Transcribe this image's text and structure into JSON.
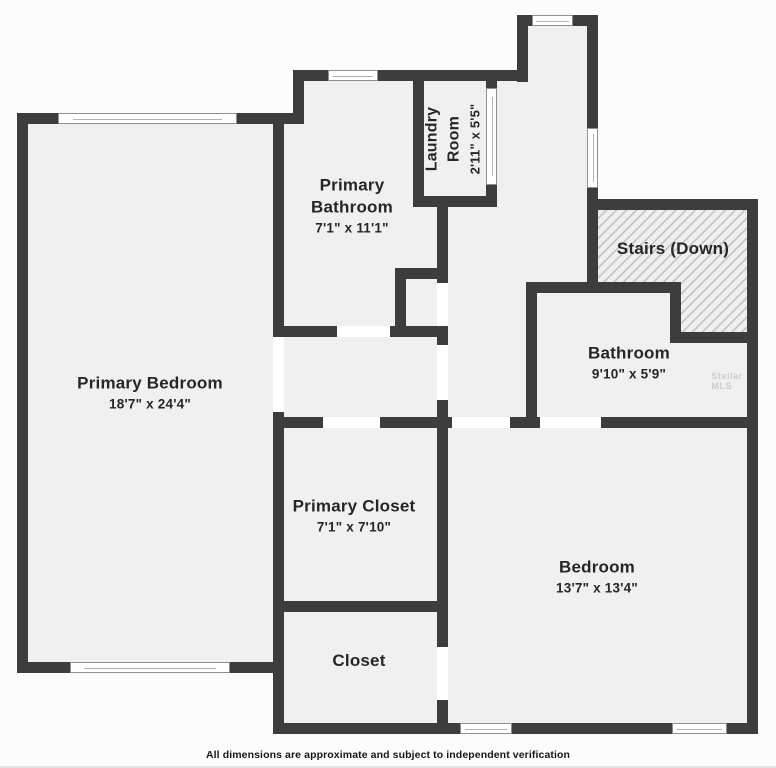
{
  "plan": {
    "disclaimer": "All dimensions are approximate and subject to independent verification",
    "watermark": "Stellar MLS",
    "colors": {
      "wall": "#3d3d3d",
      "room_fill": "#f0f0f0",
      "outside": "#fcfcfc",
      "window_fill": "#ffffff",
      "window_border": "#8f8f8f",
      "hatch_line": "#c6c6c6",
      "label_text": "#262626"
    },
    "rooms": [
      {
        "name": "Primary Bedroom",
        "dims": "18'7\" x 24'4\"",
        "cx": 150,
        "cy": 393,
        "rotate": 0,
        "wrap": 0
      },
      {
        "name": "Primary Bathroom",
        "dims": "7'1\" x 11'1\"",
        "cx": 352,
        "cy": 206,
        "rotate": 0,
        "wrap": 120
      },
      {
        "name": "Laundry Room",
        "dims": "2'11\" x 5'5\"",
        "cx": 453,
        "cy": 139,
        "rotate": -90,
        "wrap": 112,
        "name_fs": 16,
        "dims_fs": 13
      },
      {
        "name": "Stairs (Down)",
        "dims": "",
        "cx": 673,
        "cy": 249,
        "rotate": 0,
        "wrap": 0
      },
      {
        "name": "Bathroom",
        "dims": "9'10\" x 5'9\"",
        "cx": 629,
        "cy": 363,
        "rotate": 0,
        "wrap": 0
      },
      {
        "name": "Primary Closet",
        "dims": "7'1\" x 7'10\"",
        "cx": 354,
        "cy": 516,
        "rotate": 0,
        "wrap": 0
      },
      {
        "name": "Closet",
        "dims": "",
        "cx": 359,
        "cy": 661,
        "rotate": 0,
        "wrap": 0
      },
      {
        "name": "Bedroom",
        "dims": "13'7\" x 13'4\"",
        "cx": 597,
        "cy": 577,
        "rotate": 0,
        "wrap": 0
      }
    ],
    "fills": [
      [
        17,
        113,
        267,
        560
      ],
      [
        273,
        113,
        175,
        621
      ],
      [
        293,
        70,
        204,
        267
      ],
      [
        517,
        15,
        81,
        67
      ],
      [
        486,
        70,
        112,
        223
      ],
      [
        526,
        199,
        232,
        229
      ],
      [
        437,
        196,
        100,
        232
      ],
      [
        437,
        417,
        321,
        317
      ]
    ],
    "walls": [
      [
        17,
        113,
        287,
        11
      ],
      [
        17,
        113,
        11,
        560
      ],
      [
        17,
        662,
        267,
        11
      ],
      [
        273,
        113,
        11,
        224
      ],
      [
        273,
        412,
        11,
        322
      ],
      [
        293,
        70,
        11,
        54
      ],
      [
        293,
        70,
        235,
        11
      ],
      [
        413,
        70,
        11,
        137
      ],
      [
        486,
        70,
        11,
        137
      ],
      [
        413,
        196,
        84,
        11
      ],
      [
        437,
        196,
        11,
        87
      ],
      [
        395,
        268,
        53,
        11
      ],
      [
        395,
        268,
        11,
        69
      ],
      [
        273,
        326,
        175,
        11
      ],
      [
        437,
        326,
        11,
        102
      ],
      [
        517,
        15,
        11,
        67
      ],
      [
        517,
        15,
        81,
        11
      ],
      [
        587,
        15,
        11,
        278
      ],
      [
        587,
        199,
        171,
        11
      ],
      [
        747,
        199,
        11,
        535
      ],
      [
        670,
        332,
        88,
        11
      ],
      [
        670,
        282,
        11,
        61
      ],
      [
        526,
        282,
        155,
        11
      ],
      [
        526,
        282,
        11,
        146
      ],
      [
        437,
        417,
        321,
        11
      ],
      [
        273,
        417,
        175,
        11
      ],
      [
        273,
        601,
        175,
        11
      ],
      [
        437,
        417,
        11,
        317
      ],
      [
        273,
        723,
        175,
        11
      ],
      [
        437,
        723,
        321,
        11
      ]
    ],
    "windows": [
      {
        "x": 58,
        "y": 113,
        "w": 179,
        "h": 11,
        "o": "h"
      },
      {
        "x": 70,
        "y": 662,
        "w": 160,
        "h": 11,
        "o": "h"
      },
      {
        "x": 328,
        "y": 70,
        "w": 50,
        "h": 11,
        "o": "h"
      },
      {
        "x": 486,
        "y": 88,
        "w": 11,
        "h": 97,
        "o": "v"
      },
      {
        "x": 532,
        "y": 15,
        "w": 41,
        "h": 11,
        "o": "h"
      },
      {
        "x": 587,
        "y": 128,
        "w": 11,
        "h": 60,
        "o": "v"
      },
      {
        "x": 460,
        "y": 723,
        "w": 52,
        "h": 11,
        "o": "h"
      },
      {
        "x": 672,
        "y": 723,
        "w": 55,
        "h": 11,
        "o": "h"
      }
    ],
    "openings": [
      [
        273,
        337,
        11,
        75
      ],
      [
        323,
        417,
        57,
        11
      ],
      [
        337,
        326,
        53,
        11
      ],
      [
        437,
        283,
        11,
        43
      ],
      [
        437,
        345,
        11,
        55
      ],
      [
        437,
        647,
        11,
        53
      ],
      [
        452,
        417,
        58,
        11
      ],
      [
        540,
        417,
        61,
        11
      ]
    ],
    "stairs_hatch": {
      "x": 598,
      "y": 210,
      "w": 149,
      "h": 122,
      "step_x": 83,
      "step_y": 72
    },
    "watermark_pos": {
      "cx": 733,
      "cy": 381
    }
  }
}
